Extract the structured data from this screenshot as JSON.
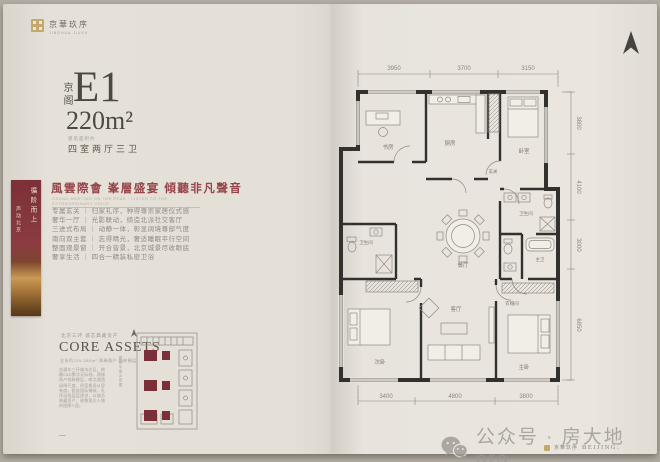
{
  "brand": {
    "logo_cn": "京華玖序",
    "logo_sub": "JINGHUA JIUXU"
  },
  "unit": {
    "prefix": "京阁",
    "model": "E1",
    "area": "220m²",
    "area_note": "建筑面积约",
    "layout": "四室两厅三卫"
  },
  "slogan": {
    "headline": "風雲際會 峯層盛宴 傾聽非凡聲音",
    "subline": "GRAND MEETING ON THE PEAK · LISTEN TO THE EXTRAORDINARY VOICE"
  },
  "features": [
    "专属玄关 ｜ 归家礼序，种得尊崇家居仪式感",
    "奢华一厅 ｜ 光影联动，缔造北派社交客厅",
    "三进式布局 ｜ 动静一体，彰显阔境尊邸气度",
    "南向双主套 ｜ 志得晴光，奢适睡眠平行空间",
    "整面观景窗 ｜ 开合皆景，北京城景尽收眼底",
    "奢享生活 ｜ 四合一精装私密卫浴"
  ],
  "side_banner": {
    "line1": "循阶而上",
    "line2": "声动北京"
  },
  "core": {
    "eyebrow": "北京三环 城芯典藏资产",
    "title": "CORE ASSETS",
    "subtitle": "全系约220-280m² 两梯两户 纯粹圈层",
    "body": "坐踞东三环城市芯区，俯瞰CBD繁华天际线。两梯两户纯粹圈层，南北通透阔绰尺度，四室格局从容有度。甄选国际臻装，礼序动线层层递进，以城芯典藏资产，致敬塔尖人物的理想人居。",
    "dash": "—"
  },
  "keyplan": {
    "caption": "楼座平面示意图"
  },
  "floorplan": {
    "dims_top": [
      "3950",
      "3700",
      "3150"
    ],
    "dims_bottom": [
      "3400",
      "4800",
      "3800"
    ],
    "dims_right": [
      "3800",
      "4100",
      "3000",
      "6850"
    ],
    "rooms": {
      "study": "书房",
      "kitchen": "厨房",
      "bedroom2": "卧室",
      "foyer": "玄关",
      "dining": "餐厅",
      "bath1": "卫生间",
      "bedroom3": "次卧",
      "bath2": "卫生间",
      "living": "客厅",
      "master": "主卧",
      "master_bath": "主卫",
      "closet": "衣帽间"
    }
  },
  "watermark": {
    "text": "公众号 · 房大地pro"
  },
  "footer": {
    "brand_cn": "京華玖序",
    "city": "BEIJING."
  },
  "colors": {
    "accent_maroon": "#96454a",
    "unit_fill": "#7b3038",
    "paper": "#e6e2da"
  }
}
